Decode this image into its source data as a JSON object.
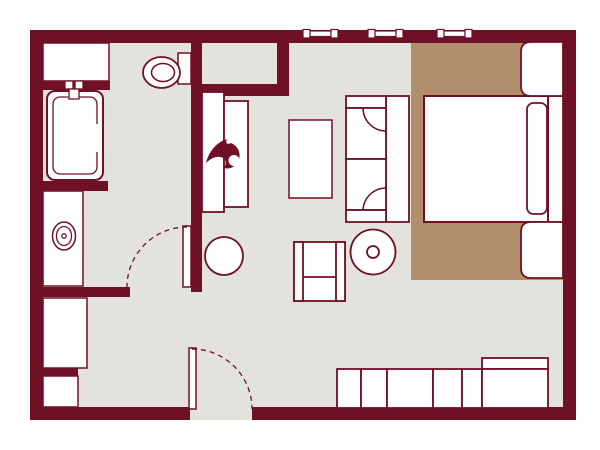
{
  "meta": {
    "title": "studio-suite-floor-plan",
    "canvas_w": 600,
    "canvas_h": 450
  },
  "palette": {
    "wall": "#701027",
    "floor": "#e4e2dd",
    "rug": "#b28e6c",
    "white": "#ffffff"
  },
  "elements": [
    {
      "name": "floor-area",
      "type": "rect",
      "x": 30,
      "y": 30,
      "w": 546,
      "h": 390,
      "f": "floor"
    },
    {
      "name": "bedroom-rug",
      "type": "rect",
      "x": 411,
      "y": 43,
      "w": 152,
      "h": 237,
      "f": "rug"
    },
    {
      "name": "wall-top",
      "type": "rect",
      "x": 30,
      "y": 30,
      "w": 546,
      "h": 13,
      "f": "wall"
    },
    {
      "name": "wall-left",
      "type": "rect",
      "x": 30,
      "y": 30,
      "w": 13,
      "h": 390,
      "f": "wall"
    },
    {
      "name": "wall-right",
      "type": "rect",
      "x": 563,
      "y": 30,
      "w": 13,
      "h": 390,
      "f": "wall"
    },
    {
      "name": "wall-bottom-left",
      "type": "rect",
      "x": 30,
      "y": 407,
      "w": 160,
      "h": 13,
      "f": "wall"
    },
    {
      "name": "wall-bottom-right",
      "type": "rect",
      "x": 252,
      "y": 407,
      "w": 324,
      "h": 13,
      "f": "wall"
    },
    {
      "name": "wall-middle-vertical",
      "type": "rect",
      "x": 191,
      "y": 43,
      "w": 11,
      "h": 249,
      "f": "wall"
    },
    {
      "name": "wall-closet-bottom",
      "type": "rect",
      "x": 191,
      "y": 84,
      "w": 98,
      "h": 12,
      "f": "wall"
    },
    {
      "name": "wall-closet-right",
      "type": "rect",
      "x": 277,
      "y": 43,
      "w": 12,
      "h": 53,
      "f": "wall"
    },
    {
      "name": "wall-stub-tub-top",
      "type": "rect",
      "x": 43,
      "y": 81,
      "w": 67,
      "h": 9,
      "f": "wall"
    },
    {
      "name": "wall-stub-tub-bottom",
      "type": "rect",
      "x": 43,
      "y": 181,
      "w": 65,
      "h": 10,
      "f": "wall"
    },
    {
      "name": "wall-stub-vanity",
      "type": "rect",
      "x": 43,
      "y": 287,
      "w": 87,
      "h": 10,
      "f": "wall"
    },
    {
      "name": "wall-stub-storage",
      "type": "rect",
      "x": 43,
      "y": 368,
      "w": 35,
      "h": 8,
      "f": "wall"
    },
    {
      "name": "window-1",
      "type": "window",
      "x": 303
    },
    {
      "name": "window-2",
      "type": "window",
      "x": 368
    },
    {
      "name": "window-3",
      "type": "window",
      "x": 437
    },
    {
      "name": "bath-shelf",
      "type": "rect",
      "x": 43,
      "y": 43,
      "w": 66,
      "h": 38,
      "f": "white",
      "s": "wall",
      "sw": 1.5
    },
    {
      "name": "bathtub",
      "type": "rect",
      "x": 47,
      "y": 91,
      "w": 56,
      "h": 89,
      "rx": 8,
      "f": "white",
      "s": "wall",
      "sw": 2
    },
    {
      "name": "bathtub-inner-rim",
      "type": "rect",
      "x": 53,
      "y": 97,
      "w": 44,
      "h": 77,
      "rx": 7,
      "f": "none",
      "s": "wall",
      "sw": 1.3
    },
    {
      "name": "bathtub-rim-gap",
      "type": "rect",
      "x": 93,
      "y": 124,
      "w": 6,
      "h": 28,
      "f": "white"
    },
    {
      "name": "faucet-handle-left",
      "type": "rect",
      "x": 65,
      "y": 81,
      "w": 8,
      "h": 8,
      "f": "white",
      "s": "wall",
      "sw": 1.3
    },
    {
      "name": "faucet-handle-right",
      "type": "rect",
      "x": 75,
      "y": 81,
      "w": 8,
      "h": 8,
      "f": "white",
      "s": "wall",
      "sw": 1.3
    },
    {
      "name": "faucet-spout",
      "type": "rect",
      "x": 69,
      "y": 89,
      "w": 10,
      "h": 10,
      "f": "white",
      "s": "wall",
      "sw": 1.3
    },
    {
      "name": "toilet-tank",
      "type": "rect",
      "x": 178,
      "y": 53,
      "w": 13,
      "h": 31,
      "f": "white",
      "s": "wall",
      "sw": 1.5
    },
    {
      "name": "toilet-bowl",
      "type": "ellipse",
      "cx": 161.5,
      "cy": 72.5,
      "rx": 18.5,
      "ry": 15.5,
      "f": "white",
      "s": "wall",
      "sw": 1.8
    },
    {
      "name": "toilet-bowl-inner",
      "type": "ellipse",
      "cx": 163,
      "cy": 72.5,
      "rx": 11.5,
      "ry": 9,
      "f": "none",
      "s": "wall",
      "sw": 1.5
    },
    {
      "name": "vanity-counter",
      "type": "rect",
      "x": 43,
      "y": 191,
      "w": 40,
      "h": 95,
      "f": "white",
      "s": "wall",
      "sw": 1.5
    },
    {
      "name": "sink-basin",
      "type": "ellipse",
      "cx": 64,
      "cy": 236,
      "rx": 11.5,
      "ry": 14,
      "f": "white",
      "s": "wall",
      "sw": 1.5
    },
    {
      "name": "sink-basin-inner",
      "type": "ellipse",
      "cx": 64,
      "cy": 236,
      "rx": 7.5,
      "ry": 9.5,
      "f": "none",
      "s": "wall",
      "sw": 1.3
    },
    {
      "name": "sink-drain",
      "type": "circle",
      "cx": 64,
      "cy": 236,
      "r": 2.2,
      "f": "none",
      "s": "wall",
      "sw": 1.3
    },
    {
      "name": "storage-cabinet-upper",
      "type": "rect",
      "x": 43,
      "y": 298,
      "w": 44,
      "h": 70,
      "f": "white",
      "s": "wall",
      "sw": 1.5
    },
    {
      "name": "storage-cabinet-lower",
      "type": "rect",
      "x": 43,
      "y": 376,
      "w": 35,
      "h": 31,
      "f": "white",
      "s": "wall",
      "sw": 1.5
    },
    {
      "name": "wardrobe-unit",
      "type": "rect",
      "x": 202,
      "y": 92,
      "w": 22,
      "h": 120,
      "f": "white",
      "s": "wall",
      "sw": 1.8
    },
    {
      "name": "fireplace-unit",
      "type": "rect",
      "x": 224,
      "y": 101,
      "w": 24,
      "h": 106,
      "f": "white",
      "s": "wall",
      "sw": 1.8
    },
    {
      "name": "flame-icon",
      "type": "path",
      "d": "M 206 163 C 209 151 217 142 227 139 C 225 143 227 145 231 143 C 238 146 241 153 239 159 C 237 166 230 170 224 168 C 227 163 226 158 220 157 C 214 156 209 160 206 163 Z",
      "f": "wall"
    },
    {
      "name": "flame-icon-notch",
      "type": "circle",
      "cx": 234,
      "cy": 160.5,
      "r": 5.5,
      "f": "white"
    },
    {
      "name": "coffee-table",
      "type": "rect",
      "x": 289,
      "y": 120,
      "w": 43,
      "h": 78,
      "f": "white",
      "s": "wall",
      "sw": 1.5
    },
    {
      "name": "sofa-back",
      "type": "rect",
      "x": 386,
      "y": 96,
      "w": 23,
      "h": 126,
      "f": "white",
      "s": "wall",
      "sw": 1.8
    },
    {
      "name": "sofa-armrest-top",
      "type": "rect",
      "x": 346,
      "y": 96,
      "w": 40,
      "h": 12,
      "f": "white",
      "s": "wall",
      "sw": 1.8
    },
    {
      "name": "sofa-cushion-top",
      "type": "rect",
      "x": 346,
      "y": 108,
      "w": 40,
      "h": 51,
      "f": "white",
      "s": "wall",
      "sw": 1.8
    },
    {
      "name": "sofa-cushion-bottom",
      "type": "rect",
      "x": 346,
      "y": 159,
      "w": 40,
      "h": 51,
      "f": "white",
      "s": "wall",
      "sw": 1.8
    },
    {
      "name": "sofa-armrest-bottom",
      "type": "rect",
      "x": 346,
      "y": 210,
      "w": 40,
      "h": 12,
      "f": "white",
      "s": "wall",
      "sw": 1.8
    },
    {
      "name": "sofa-cushion-top-seam",
      "type": "arc",
      "cx": 386,
      "cy": 108,
      "r": 23,
      "a0": 180,
      "a1": 90,
      "s": "wall",
      "sw": 1.5
    },
    {
      "name": "sofa-cushion-bottom-seam",
      "type": "arc",
      "cx": 386,
      "cy": 211,
      "r": 23,
      "a0": 180,
      "a1": 270,
      "s": "wall",
      "sw": 1.5
    },
    {
      "name": "bed-headboard",
      "type": "rect",
      "x": 548,
      "y": 96,
      "w": 15,
      "h": 126,
      "f": "white",
      "s": "wall",
      "sw": 1.8
    },
    {
      "name": "bed-mattress",
      "type": "rect",
      "x": 424,
      "y": 96,
      "w": 124,
      "h": 126,
      "f": "white",
      "s": "wall",
      "sw": 2
    },
    {
      "name": "bed-pillow",
      "type": "rect",
      "x": 527,
      "y": 103,
      "w": 20,
      "h": 111,
      "rx": 6.5,
      "f": "white",
      "s": "wall",
      "sw": 1.8
    },
    {
      "name": "nightstand-top",
      "type": "lrect",
      "x": 521,
      "y": 42,
      "w": 42,
      "h": 54,
      "r": 10,
      "f": "white",
      "s": "wall",
      "sw": 1.8
    },
    {
      "name": "nightstand-bottom",
      "type": "lrect",
      "x": 521,
      "y": 222,
      "w": 42,
      "h": 56,
      "r": 10,
      "f": "white",
      "s": "wall",
      "sw": 1.8
    },
    {
      "name": "armchair-body",
      "type": "rect",
      "x": 294,
      "y": 242,
      "w": 51,
      "h": 59,
      "f": "white",
      "s": "wall",
      "sw": 1.8
    },
    {
      "name": "armchair-arm-left",
      "type": "rect",
      "x": 294,
      "y": 242,
      "w": 9,
      "h": 59,
      "f": "white",
      "s": "wall",
      "sw": 1.8
    },
    {
      "name": "armchair-arm-right",
      "type": "rect",
      "x": 336,
      "y": 242,
      "w": 9,
      "h": 59,
      "f": "white",
      "s": "wall",
      "sw": 1.8
    },
    {
      "name": "armchair-seat-divider",
      "type": "line",
      "x1": 303,
      "y1": 277,
      "x2": 336,
      "y2": 277,
      "s": "wall",
      "sw": 1.8
    },
    {
      "name": "side-table-round",
      "type": "circle",
      "cx": 373,
      "cy": 252,
      "r": 22.5,
      "f": "white",
      "s": "wall",
      "sw": 1.8
    },
    {
      "name": "side-table-center",
      "type": "circle",
      "cx": 373,
      "cy": 252,
      "r": 6,
      "f": "white",
      "s": "wall",
      "sw": 1.8
    },
    {
      "name": "round-table",
      "type": "circle",
      "cx": 224,
      "cy": 256,
      "r": 19,
      "f": "white",
      "s": "wall",
      "sw": 1.8
    },
    {
      "name": "bathroom-door-leaf",
      "type": "rect",
      "x": 183,
      "y": 226,
      "w": 8,
      "h": 61,
      "f": "white",
      "s": "wall",
      "sw": 1.5
    },
    {
      "name": "bathroom-door-swing",
      "type": "arc",
      "cx": 187,
      "cy": 287,
      "r": 60,
      "a0": 270,
      "a1": 180,
      "s": "wall",
      "sw": 1.3,
      "dash": "5 4"
    },
    {
      "name": "entry-door-leaf",
      "type": "rect",
      "x": 189,
      "y": 348,
      "w": 7,
      "h": 61,
      "f": "white",
      "s": "wall",
      "sw": 1.5
    },
    {
      "name": "entry-door-swing",
      "type": "arc",
      "cx": 192,
      "cy": 409,
      "r": 60,
      "a0": 270,
      "a1": 360,
      "s": "wall",
      "sw": 1.3,
      "dash": "5 4"
    },
    {
      "name": "credenza-segment-1",
      "type": "rect",
      "x": 337,
      "y": 369,
      "w": 24,
      "h": 39,
      "f": "white",
      "s": "wall",
      "sw": 1.8
    },
    {
      "name": "credenza-segment-2",
      "type": "rect",
      "x": 361,
      "y": 369,
      "w": 26,
      "h": 39,
      "f": "white",
      "s": "wall",
      "sw": 1.8
    },
    {
      "name": "credenza-segment-3",
      "type": "rect",
      "x": 387,
      "y": 369,
      "w": 46,
      "h": 39,
      "f": "white",
      "s": "wall",
      "sw": 1.8
    },
    {
      "name": "credenza-segment-4",
      "type": "rect",
      "x": 433,
      "y": 369,
      "w": 29,
      "h": 39,
      "f": "white",
      "s": "wall",
      "sw": 1.8
    },
    {
      "name": "credenza-segment-5",
      "type": "rect",
      "x": 462,
      "y": 369,
      "w": 20,
      "h": 39,
      "f": "white",
      "s": "wall",
      "sw": 1.8
    },
    {
      "name": "luggage-bench-back",
      "type": "rect",
      "x": 482,
      "y": 358,
      "w": 66,
      "h": 11,
      "f": "white",
      "s": "wall",
      "sw": 1.8
    },
    {
      "name": "luggage-bench",
      "type": "rect",
      "x": 482,
      "y": 369,
      "w": 66,
      "h": 39,
      "f": "white",
      "s": "wall",
      "sw": 1.8
    }
  ]
}
